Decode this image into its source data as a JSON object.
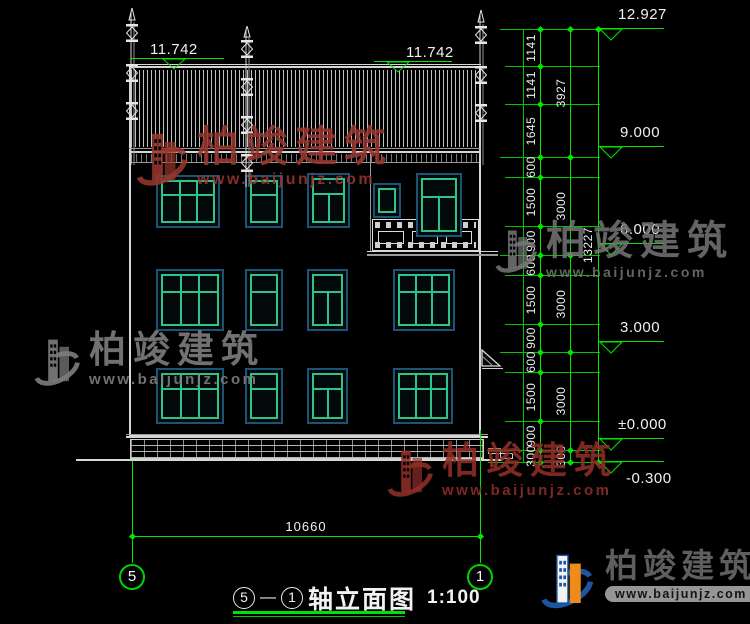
{
  "watermark": {
    "brand": "柏竣建筑",
    "url": "www.baijunjz.com"
  },
  "logo": {
    "brand": "柏竣建筑",
    "url": "www.baijunjz.com"
  },
  "title": {
    "axis_from": "5",
    "separator": "—",
    "axis_to": "1",
    "name": "轴立面图",
    "scale": "1:100"
  },
  "axis_bubbles": {
    "left": "5",
    "right": "1"
  },
  "dims": {
    "overall_width": "10660",
    "eave_left": "11.742",
    "eave_right": "11.742",
    "total_height": "13227",
    "chain_inner": [
      "1141",
      "1141",
      "1645",
      "600",
      "1500",
      "900",
      "600",
      "1500",
      "900",
      "600",
      "1500",
      "900",
      "300"
    ],
    "chain_mid": [
      "3927",
      "3000",
      "3000",
      "3000",
      "300"
    ],
    "elevations": [
      "12.927",
      "9.000",
      "6.000",
      "3.000",
      "±0.000",
      "-0.300"
    ]
  }
}
